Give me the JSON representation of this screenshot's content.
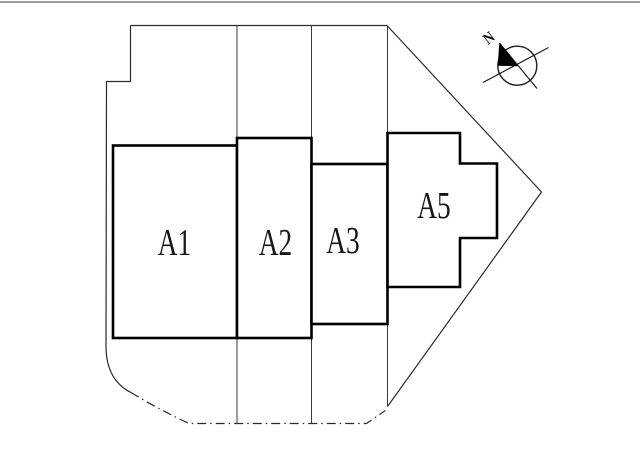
{
  "page": {
    "background": "#ffffff",
    "top_rule_color": "#9b9b9b"
  },
  "plan": {
    "type": "site-plan",
    "blocks": [
      {
        "label": "A1"
      },
      {
        "label": "A2"
      },
      {
        "label": "A3"
      },
      {
        "label": "A5"
      }
    ],
    "compass": {
      "north_label": "N"
    },
    "colors": {
      "block_outline": "#000000",
      "boundary_line": "#2b2b2b",
      "lot_line": "#3a3a3a",
      "label_text": "#161616"
    }
  }
}
